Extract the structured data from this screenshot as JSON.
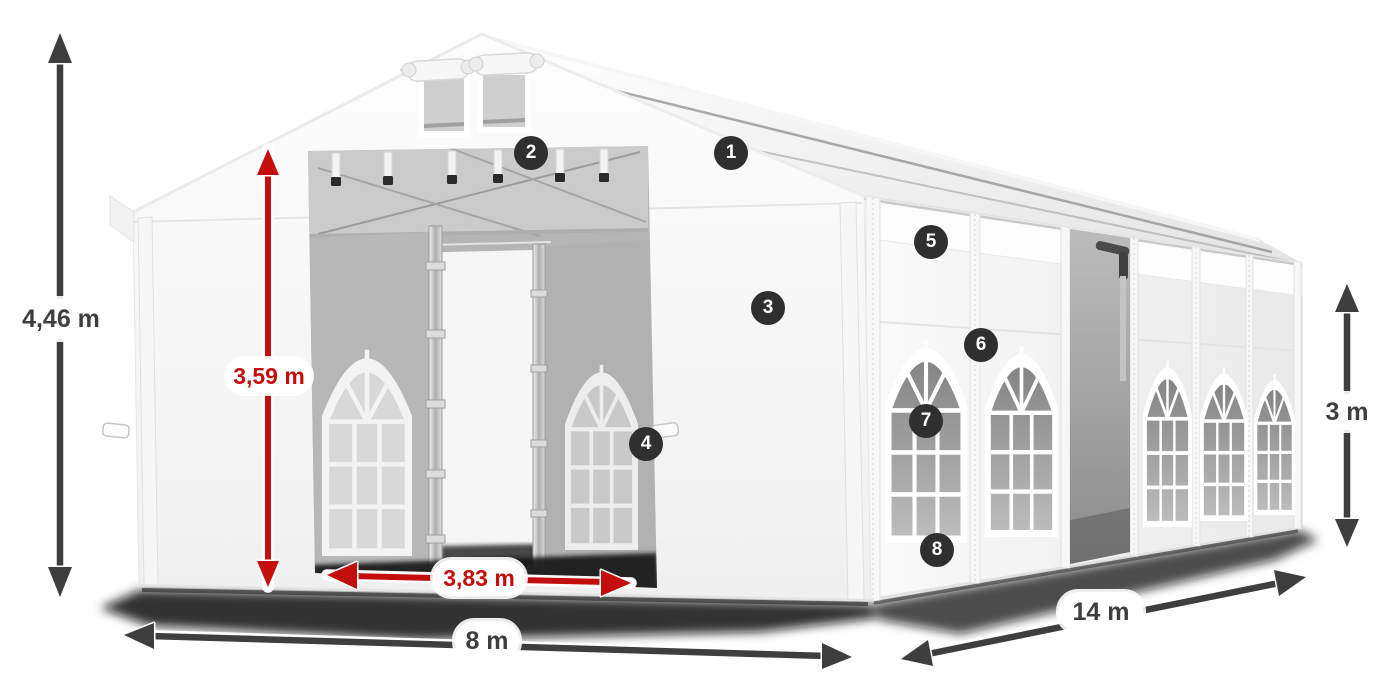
{
  "illustration": {
    "name": "tent-dimensions-diagram",
    "dimension_labels": {
      "total_height": "4,46 m",
      "entrance_height": "3,59 m",
      "entrance_width": "3,83 m",
      "front_width": "8 m",
      "side_length": "14 m",
      "wall_height": "3 m"
    },
    "callouts": [
      {
        "label": "1"
      },
      {
        "label": "2"
      },
      {
        "label": "3"
      },
      {
        "label": "4"
      },
      {
        "label": "5"
      },
      {
        "label": "6"
      },
      {
        "label": "7"
      },
      {
        "label": "8"
      }
    ],
    "colors": {
      "dimension_arrow": "#3e3e3e",
      "accent_red": "#c40e0e",
      "callout_background": "#2f2f2f",
      "callout_text": "#ffffff"
    }
  }
}
